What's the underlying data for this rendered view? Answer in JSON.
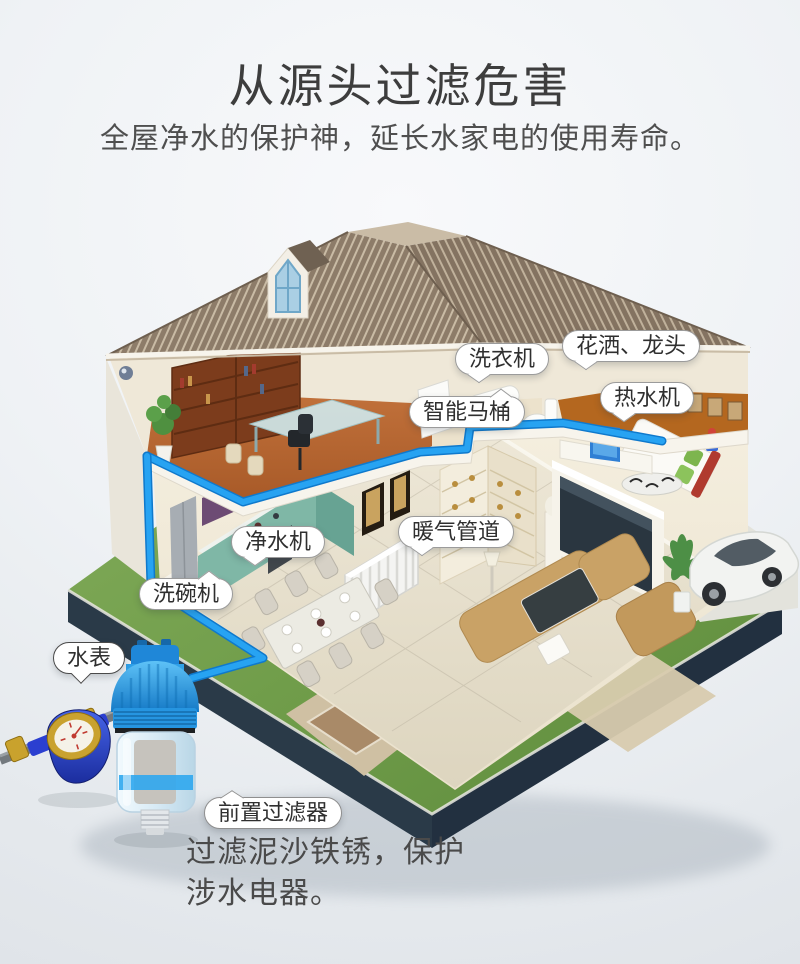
{
  "header": {
    "title": "从源头过滤危害",
    "subtitle": "全屋净水的保护神，延长水家电的使用寿命。"
  },
  "callouts": {
    "washing_machine": "洗衣机",
    "shower_faucet": "花洒、龙头",
    "water_heater": "热水机",
    "smart_toilet": "智能马桶",
    "water_purifier": "净水机",
    "heating_pipes": "暖气管道",
    "dishwasher": "洗碗机",
    "water_meter": "水表",
    "prefilter": "前置过滤器"
  },
  "description": {
    "line1": "过滤泥沙铁锈，保护",
    "line2": "涉水电器。"
  },
  "colors": {
    "pipe_blue": "#1e9bef",
    "roof_brown": "#887765",
    "lawn_green": "#76a24f",
    "foundation_dark": "#2a3a48",
    "filter_blue": "#2e9fe8",
    "meter_blue": "#2b3fd0",
    "brass": "#c9a22d"
  }
}
